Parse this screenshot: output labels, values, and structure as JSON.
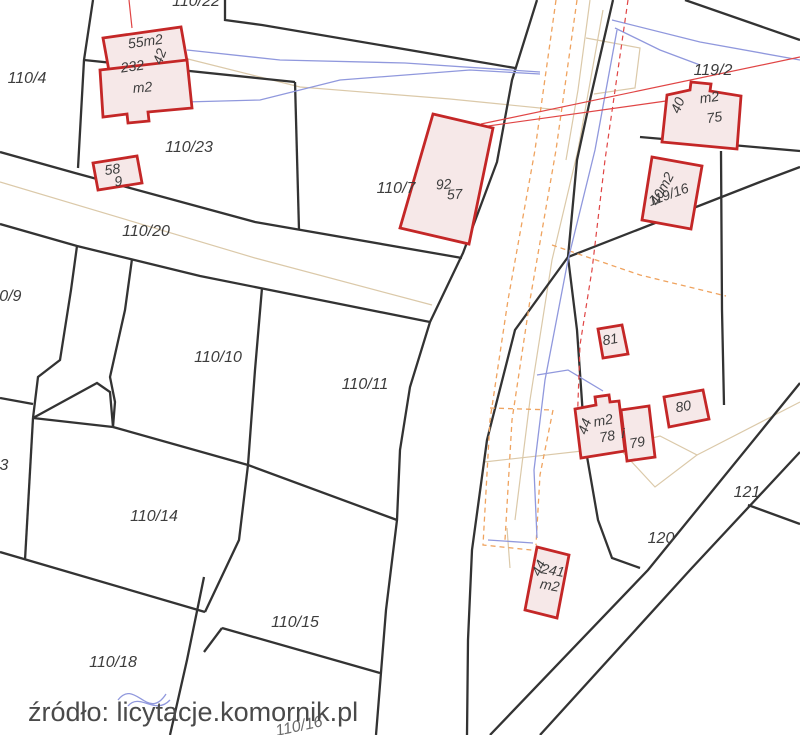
{
  "map": {
    "caption": "źródło: licytacje.komornik.pl",
    "colors": {
      "background": "#ffffff",
      "parcel_line": "#333333",
      "building_stroke": "#c42727",
      "building_fill": "#f6e8e8",
      "faint_survey_line": "#dbc9a9",
      "utility_orange": "#efa35f",
      "utility_blue": "#9098dd",
      "utility_red": "#e04545",
      "label_color": "#3d3d3d",
      "caption_color": "#4a4a4a"
    },
    "parcels": [
      {
        "label": "110/4"
      },
      {
        "label": "110/22"
      },
      {
        "label": "110/23"
      },
      {
        "label": "110/20"
      },
      {
        "label": "110/9"
      },
      {
        "label": "110/10"
      },
      {
        "label": "110/11"
      },
      {
        "label": "110/7"
      },
      {
        "label": "110/14"
      },
      {
        "label": "110/15"
      },
      {
        "label": "110/18"
      },
      {
        "label": "119/2"
      },
      {
        "label": "121"
      },
      {
        "label": "120"
      },
      {
        "label": "110/16"
      },
      {
        "label": "3"
      }
    ],
    "buildings": [
      {
        "labels": [
          "55m2",
          "42",
          "232",
          "m2"
        ]
      },
      {
        "labels": [
          "58",
          "9"
        ]
      },
      {
        "labels": [
          "92",
          "57"
        ]
      },
      {
        "labels": [
          "40",
          "m2",
          "75"
        ]
      },
      {
        "labels": [
          "40m2",
          "119/16"
        ]
      },
      {
        "labels": [
          "81"
        ]
      },
      {
        "labels": [
          "80"
        ]
      },
      {
        "labels": [
          "44",
          "m2",
          "78"
        ]
      },
      {
        "labels": [
          "i",
          "79"
        ]
      },
      {
        "labels": [
          "44",
          "241",
          "m2"
        ]
      }
    ]
  }
}
